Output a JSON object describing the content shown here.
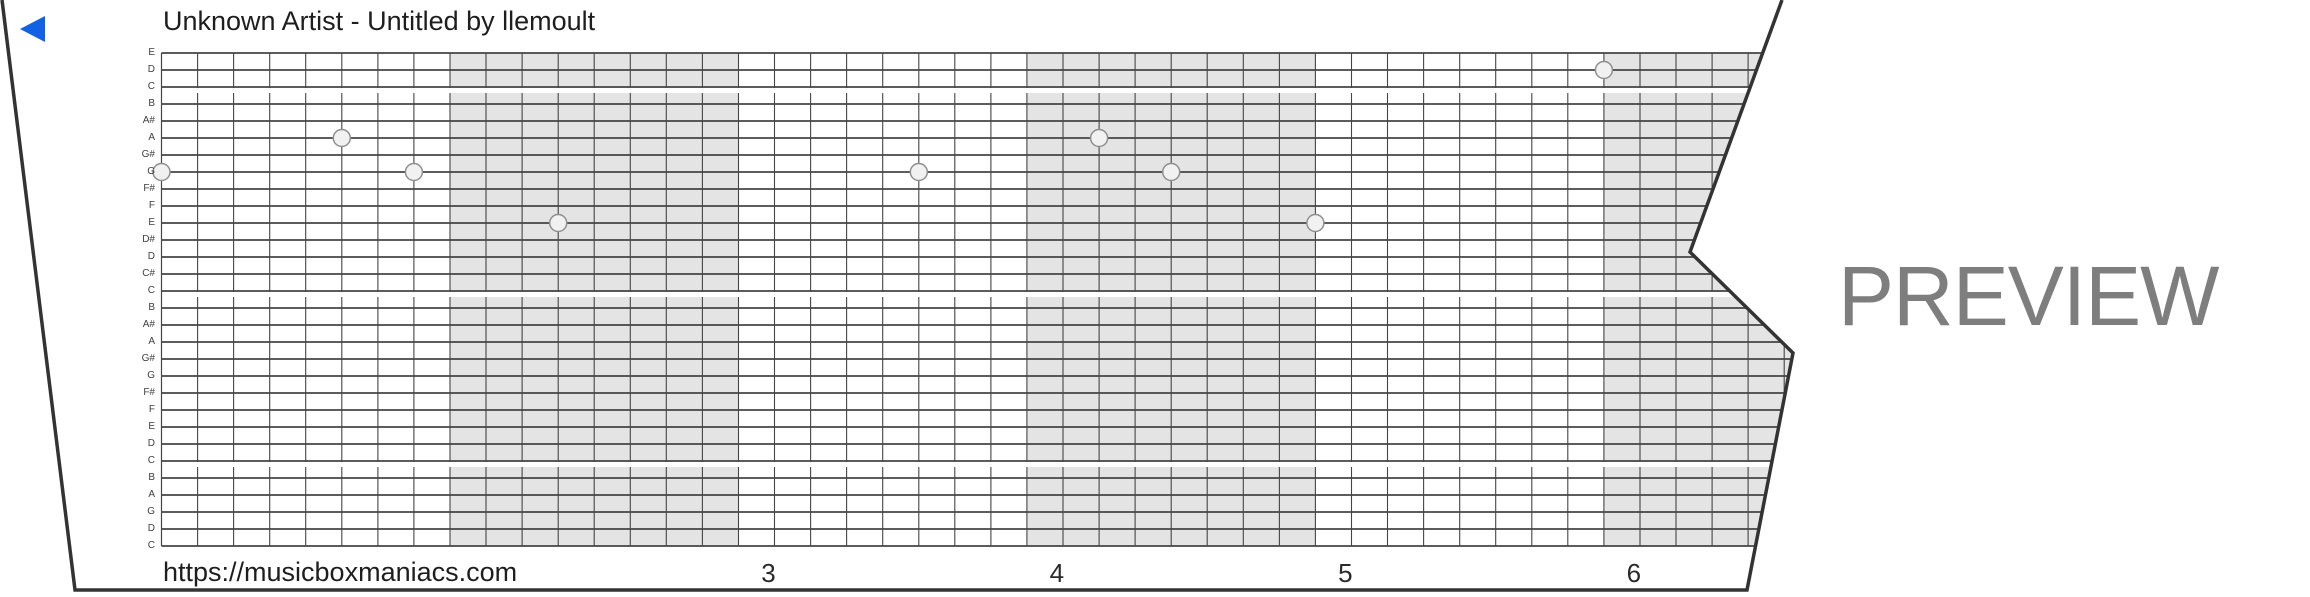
{
  "header": {
    "title": "Unknown Artist - Untitled by llemoult"
  },
  "watermark": {
    "text": "PREVIEW",
    "color": "#7e7e7e"
  },
  "footer": {
    "url": "https://musicboxmaniacs.com",
    "beat_numbers": [
      {
        "label": "3",
        "measure": 2
      },
      {
        "label": "4",
        "measure": 3
      },
      {
        "label": "5",
        "measure": 4
      },
      {
        "label": "6",
        "measure": 5
      }
    ]
  },
  "strip": {
    "colors": {
      "paper": "#ffffff",
      "edge": "#333333",
      "grid_line": "#454545",
      "measure_shade": "#e4e4e4",
      "note_fill": "#f1f1f1",
      "note_stroke": "#8f8f8f",
      "play_button": "#1261e4"
    },
    "pitch_labels": [
      "E",
      "D",
      "C",
      "B",
      "A#",
      "A",
      "G#",
      "G",
      "F#",
      "F",
      "E",
      "D#",
      "D",
      "C#",
      "C",
      "B",
      "A#",
      "A",
      "G#",
      "G",
      "F#",
      "F",
      "E",
      "D",
      "C",
      "B",
      "A",
      "G",
      "D",
      "C"
    ],
    "octave_breaks_after_rows": [
      2,
      14,
      24
    ],
    "shaded_measures": [
      1,
      3,
      5
    ],
    "notes": [
      {
        "col": 0,
        "row": 7,
        "pitch": "G"
      },
      {
        "col": 5,
        "row": 5,
        "pitch": "A"
      },
      {
        "col": 7,
        "row": 7,
        "pitch": "G"
      },
      {
        "col": 11,
        "row": 10,
        "pitch": "E"
      },
      {
        "col": 21,
        "row": 7,
        "pitch": "G"
      },
      {
        "col": 26,
        "row": 5,
        "pitch": "A"
      },
      {
        "col": 28,
        "row": 7,
        "pitch": "G"
      },
      {
        "col": 32,
        "row": 10,
        "pitch": "E"
      },
      {
        "col": 40,
        "row": 1,
        "pitch": "D"
      }
    ]
  }
}
